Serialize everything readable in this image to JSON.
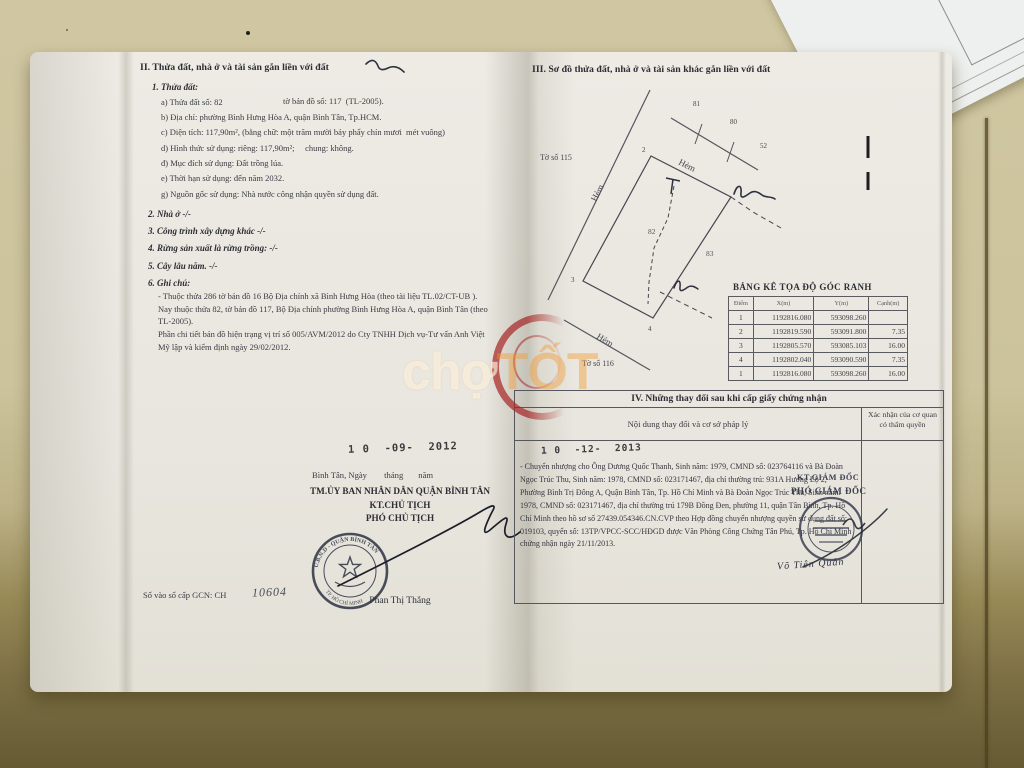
{
  "watermark": {
    "part1": "chợ",
    "part2": "TỐT"
  },
  "left_page": {
    "heading": "II. Thửa đất, nhà ở và tài sản gắn liền với đất",
    "s1_title": "1. Thửa đất:",
    "a_label": "a) Thửa đất số: 82",
    "a_right": "tờ bản đồ số: 117  (TL-2005).",
    "b": "b) Địa chỉ: phường Bình Hưng Hòa A, quận Bình Tân, Tp.HCM.",
    "c": "c) Diện tích: 117,90m², (bằng chữ: một trăm mười bảy phẩy chín mươi  mét vuông)",
    "d": "d) Hình thức sử dụng: riêng: 117,90m²;     chung: không.",
    "dd": "đ) Mục đích sử dụng: Đất trồng lúa.",
    "e": "e) Thời hạn sử dụng: đến năm 2032.",
    "g": "g) Nguồn gốc sử dụng: Nhà nước công nhận quyền sử dụng đất.",
    "s2": "2. Nhà ở -/-",
    "s3": "3. Công trình xây dựng khác -/-",
    "s4": "4. Rừng sản xuất là rừng trồng: -/-",
    "s5": "5. Cây lâu năm. -/-",
    "s6": "6. Ghi chú:",
    "note1": "- Thuộc thửa 286 tờ bản đồ 16 Bộ Địa chính xã Bình Hưng Hòa (theo tài liệu TL.02/CT-UB ). Nay thuộc thửa 82,  tờ bản đồ 117, Bộ Địa chính phường Bình Hưng Hòa A, quận Bình Tân (theo TL-2005).",
    "note2": "Phần chi tiết  bản đồ hiện trạng vị trí số  005/AVM/2012 do Cty TNHH Dịch vụ-Tư vấn Anh Việt Mỹ lập và kiểm định ngày 29/02/2012.",
    "date_stamp": "1 0  -09-  2012",
    "place_line": "Bình Tân, Ngày        tháng       năm",
    "org_line": "TM.ỦY BAN NHÂN DÂN QUẬN BÌNH TÂN",
    "title1": "KT.CHỦ TỊCH",
    "title2": "PHÓ CHỦ TỊCH",
    "signer": "Phan Thị Thắng",
    "book_label": "Số vào sổ cấp GCN: CH",
    "book_number": "10604",
    "stamp_arc_top": "U.B.N.D - QUẬN BÌNH TÂN",
    "stamp_arc_bottom": "TP. HỒ CHÍ MINH"
  },
  "right_page": {
    "heading": "III. Sơ đồ thửa đất, nhà ở và tài sản khác gắn liền với đất",
    "map": {
      "to_so_115": "Tờ số 115",
      "to_so_116": "Tờ số 116",
      "hem1": "Hẻm",
      "hem2": "Hẻm",
      "hem3": "Hẻm",
      "l81": "81",
      "l80": "80",
      "l52": "52",
      "p2": "2",
      "p3": "3",
      "p4": "4",
      "parcel": "82",
      "neighbor": "83"
    },
    "coord_table": {
      "title": "BẢNG KÊ TỌA ĐỘ GÓC RANH",
      "headers": [
        "Điểm",
        "X(m)",
        "Y(m)",
        "Cạnh(m)"
      ],
      "rows": [
        {
          "diem": "1",
          "x": "1192816.080",
          "y": "593098.260",
          "canh": ""
        },
        {
          "diem": "2",
          "x": "1192819.590",
          "y": "593091.800",
          "canh": "7.35"
        },
        {
          "diem": "3",
          "x": "1192805.570",
          "y": "593085.103",
          "canh": "16.00"
        },
        {
          "diem": "4",
          "x": "1192802.040",
          "y": "593090.590",
          "canh": "7.35"
        },
        {
          "diem": "1",
          "x": "1192816.080",
          "y": "593098.260",
          "canh": "16.00"
        }
      ]
    },
    "section4": {
      "title": "IV. Những thay đổi sau khi cấp giấy chứng nhận",
      "col1_header": "Nội dung thay đổi và cơ sở pháp lý",
      "col2_header": "Xác nhận của cơ quan có thẩm quyền",
      "date_stamp": "1 0  -12-  2013",
      "body": "- Chuyển nhượng cho Ông Dương Quốc Thanh, Sinh năm: 1979, CMND số: 023764116 và Bà Đoàn Ngọc Trúc Thu, Sinh năm: 1978, CMND số: 023171467, địa chỉ thường trú: 931A Hương Lộ 2, Phường Bình Trị Đông A, Quận Bình Tân, Tp. Hồ Chí Minh và Bà Đoàn Ngọc Trúc Thu, Sinh năm: 1978, CMND số: 023171467, địa chỉ thường trú 179B Đồng Đen, phường 11, quận Tân Bình, Tp. Hồ Chí Minh theo hồ sơ số 27439.054346.CN.CVP theo Hợp đồng chuyển nhượng quyền sử dụng đất số: 019103, quyển số: 13TP/VPCC-SCC/HĐGD được Văn Phòng Công Chứng Tân Phú, Tp. Hồ Chí Minh chứng nhận ngày 21/11/2013.",
      "approver_title1": "KT.GIÁM ĐỐC",
      "approver_title2": "PHÓ GIÁM ĐỐC",
      "approver_name": "Võ Tiên Quân"
    }
  },
  "colors": {
    "stamp_red": "#a82828",
    "ink_dark": "#2e3140",
    "watermark_orange": "#f2982a"
  }
}
